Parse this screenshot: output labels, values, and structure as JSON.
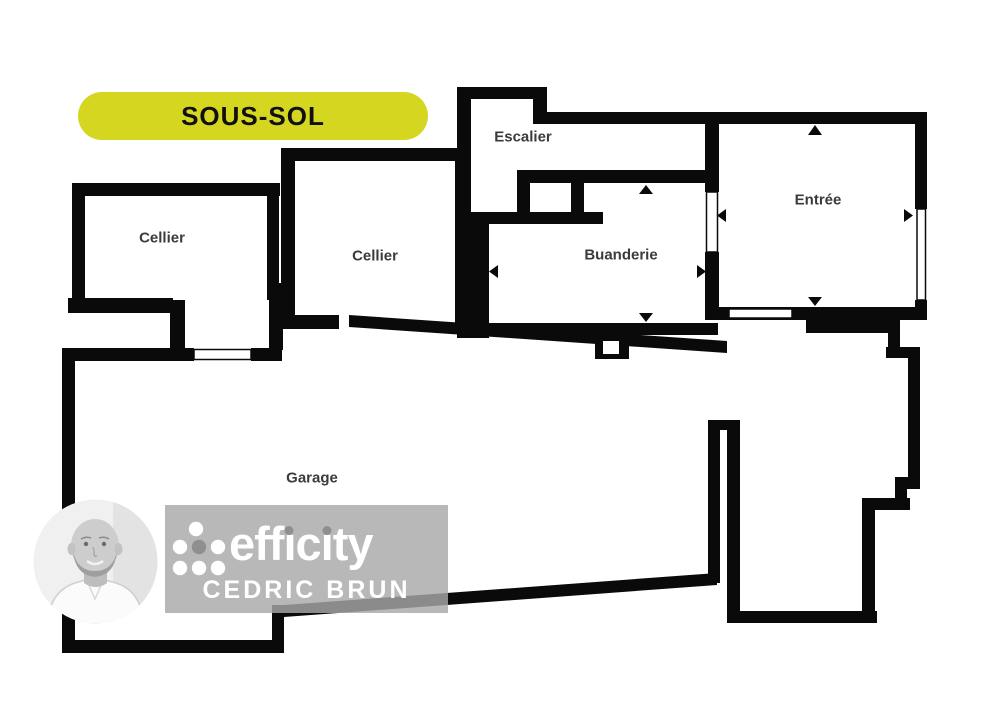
{
  "badge": {
    "label": "SOUS-SOL",
    "bg_color": "#d4d61f",
    "text_color": "#101010"
  },
  "rooms": {
    "cellier_left": {
      "label": "Cellier"
    },
    "cellier_middle": {
      "label": "Cellier"
    },
    "escalier": {
      "label": "Escalier"
    },
    "buanderie": {
      "label": "Buanderie"
    },
    "entree": {
      "label": "Entrée"
    },
    "garage": {
      "label": "Garage"
    }
  },
  "plan": {
    "wall_color": "#0a0a0a",
    "label_color": "#3b3b3b",
    "icons": {
      "dimension_arrows": "small black triangles at mid-walls of Buanderie and Entrée pointing up/down/left/right",
      "openings": "white slots with thin outline for doors and windows"
    }
  },
  "branding": {
    "agency": "efficity",
    "agent": "CEDRIC BRUN",
    "wordmark_parts": {
      "p1": "eff",
      "i1": "ı",
      "p2": "c",
      "i2": "ı",
      "p3": "ty"
    },
    "panel_color": "#a8a8a8",
    "logo_dot_color": "#ffffff",
    "logo_accent_dot_color": "#8f8f8f",
    "text_color": "#ffffff"
  }
}
